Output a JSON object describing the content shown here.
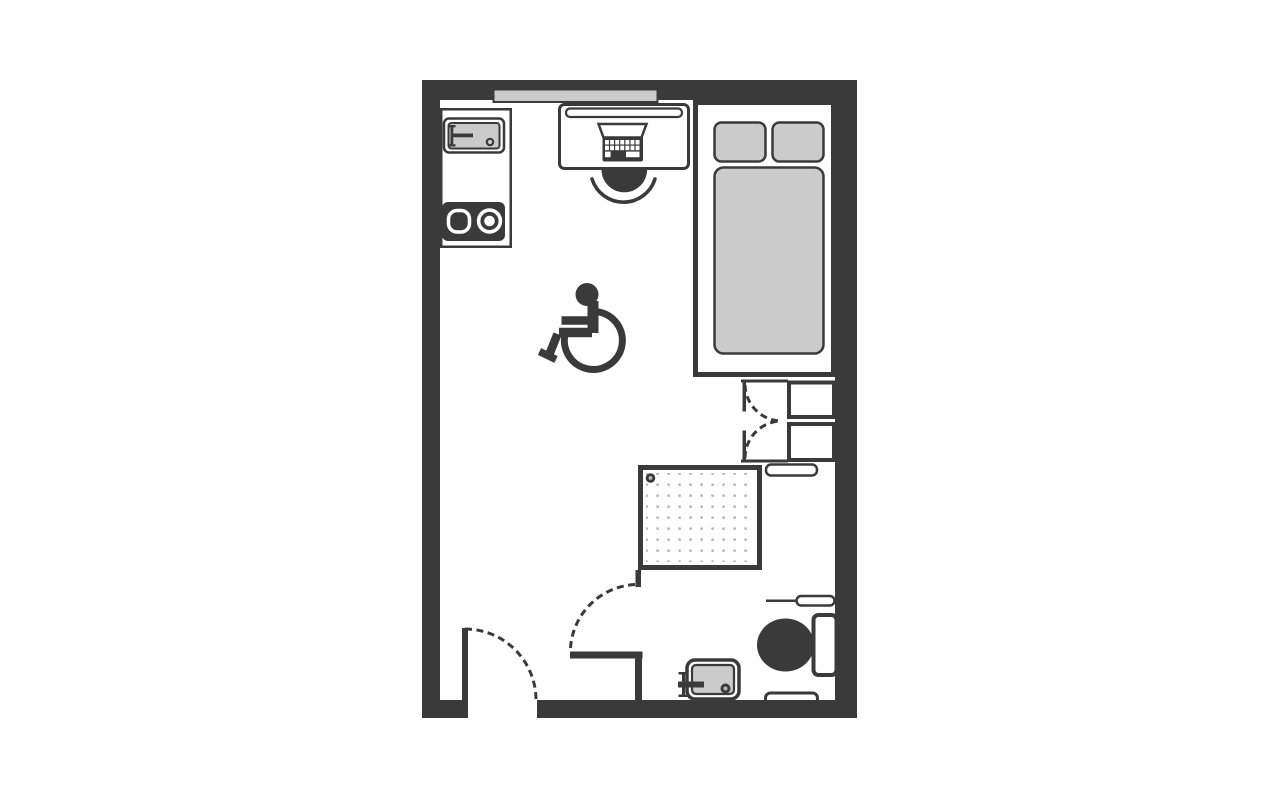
{
  "image": {
    "title": "Accessible studio room floor plan"
  },
  "colors": {
    "background": "#ffffff",
    "wall": "#3a3a3a",
    "fixture_gray": "#cbcbcb",
    "dot_gray": "#b9b9b9"
  },
  "elements": {
    "room": {
      "label": "Studio room outline with exterior walls"
    },
    "window": {
      "label": "Window above desk"
    },
    "entry_door": {
      "label": "Entry door leaf with dashed swing arc"
    },
    "kitchenette": {
      "label": "Kitchenette unit"
    },
    "kitchen_sink": {
      "label": "Kitchen sink with tap and drain"
    },
    "hob": {
      "label": "Two-burner hob"
    },
    "desk": {
      "label": "Desk"
    },
    "desk_shelf": {
      "label": "Shelf on desk"
    },
    "laptop": {
      "label": "Laptop with keyboard"
    },
    "chair": {
      "label": "Desk chair"
    },
    "bed": {
      "label": "Bed platform"
    },
    "pillow_left": {
      "label": "Left pillow"
    },
    "pillow_right": {
      "label": "Right pillow"
    },
    "mattress": {
      "label": "Mattress"
    },
    "wardrobe": {
      "label": "Wardrobe with double doors and shelves"
    },
    "towel_rail": {
      "label": "Towel rail below wardrobe"
    },
    "shower": {
      "label": "Roll-in shower tray with drain"
    },
    "bathroom_partition": {
      "label": "Bathroom partition wall"
    },
    "bathroom_door": {
      "label": "Bathroom door dashed swing arc"
    },
    "grab_rail": {
      "label": "Fold-up grab rail beside toilet"
    },
    "toilet": {
      "label": "Toilet with cistern"
    },
    "basin": {
      "label": "Wash basin with tap and drain"
    },
    "wall_rail": {
      "label": "Grab rail on bottom wall"
    },
    "accessibility_symbol": {
      "label": "Wheelchair accessibility symbol"
    }
  }
}
